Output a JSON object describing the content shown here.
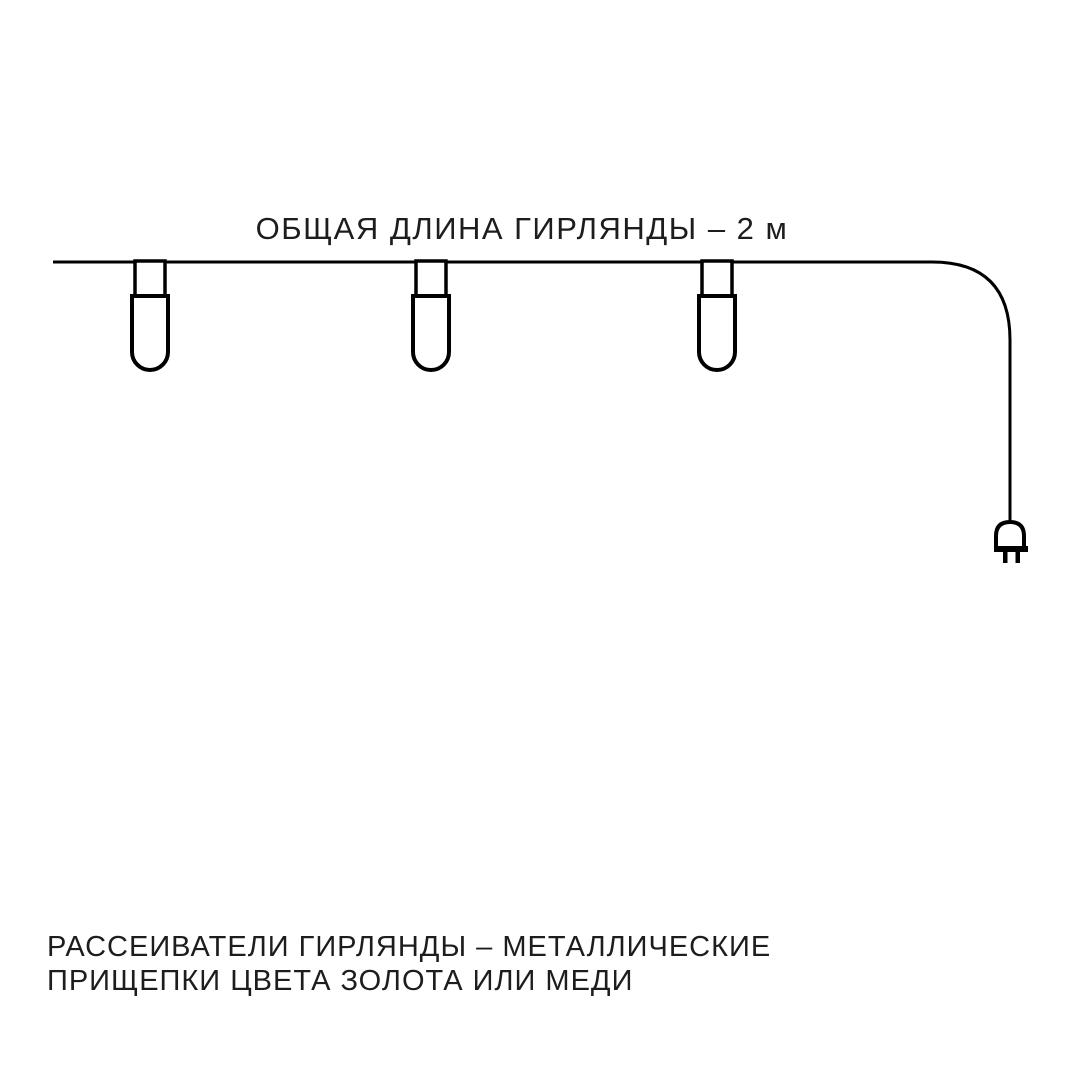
{
  "title": {
    "text": "ОБЩАЯ ДЛИНА ГИРЛЯНДЫ – 2 м"
  },
  "caption": {
    "line1": "РАССЕИВАТЕЛИ ГИРЛЯНДЫ – МЕТАЛЛИЧЕСКИЕ",
    "line2": "ПРИЩЕПКИ ЦВЕТА ЗОЛОТА ИЛИ МЕДИ"
  },
  "diagram": {
    "lamp_count": 3,
    "icons": [
      "garland-wire",
      "clip-lamp-icon",
      "plug-icon"
    ],
    "colors": {
      "line": "#000000",
      "text": "#1d1d1d",
      "background": "#ffffff"
    }
  }
}
